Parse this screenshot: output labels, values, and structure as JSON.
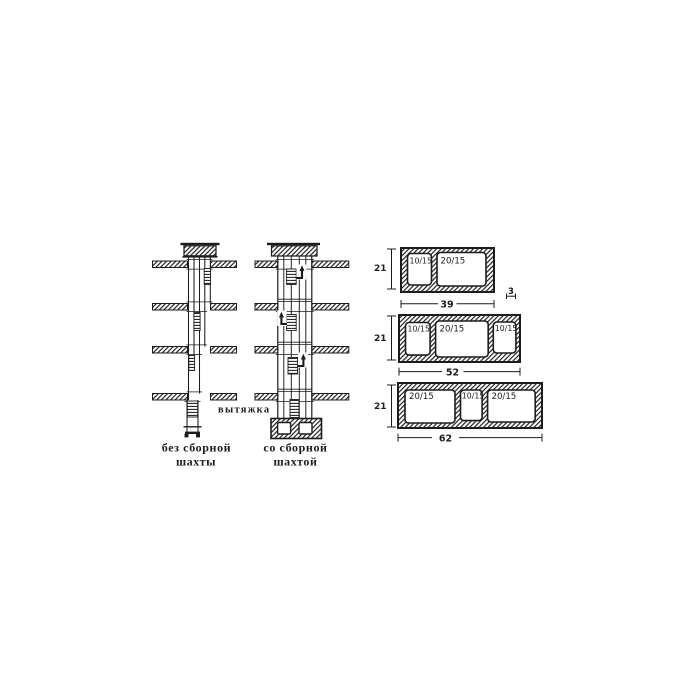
{
  "meta": {
    "ink_color": "#1c1c1c",
    "paper_color": "#ffffff",
    "description": "Scanned technical diagram of ventilation shafts and prefabricated duct block cross-sections"
  },
  "figure": {
    "left_shaft": {
      "exhaust_label": "вытяжка",
      "caption_line1": "без сборной",
      "caption_line2": "шахты"
    },
    "right_shaft": {
      "caption_line1": "со сборной",
      "caption_line2": "шахтой"
    },
    "sections": [
      {
        "height_label": "21",
        "width_label": "39",
        "wall_thickness_label": "3",
        "openings": [
          "10/15",
          "20/15"
        ]
      },
      {
        "height_label": "21",
        "width_label": "52",
        "openings": [
          "10/15",
          "20/15",
          "10/15"
        ]
      },
      {
        "height_label": "21",
        "width_label": "62",
        "openings": [
          "20/15",
          "10/15",
          "20/15"
        ]
      }
    ]
  }
}
